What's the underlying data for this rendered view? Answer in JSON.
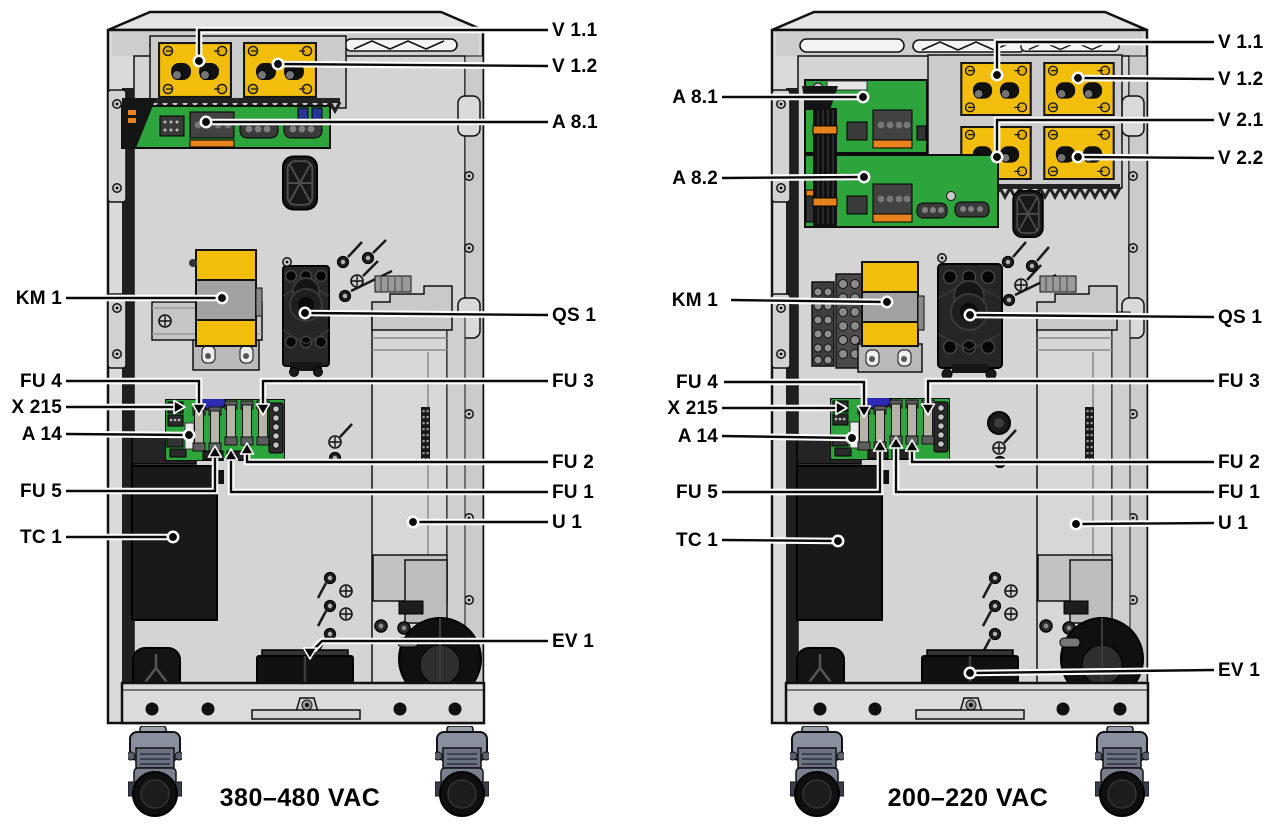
{
  "figure": {
    "description": "Interior component location diagrams of two power-source cabinet variants",
    "left_unit": {
      "caption": "380–480 VAC",
      "labels": {
        "v11": "V 1.1",
        "v12": "V 1.2",
        "a81": "A 8.1",
        "km1": "KM 1",
        "qs1": "QS 1",
        "fu4": "FU 4",
        "fu3": "FU 3",
        "x215": "X 215",
        "a14": "A 14",
        "fu2": "FU 2",
        "fu5": "FU 5",
        "fu1": "FU 1",
        "tc1": "TC 1",
        "u1": "U 1",
        "ev1": "EV 1"
      }
    },
    "right_unit": {
      "caption": "200–220 VAC",
      "labels": {
        "v11": "V 1.1",
        "v12": "V 1.2",
        "v21": "V 2.1",
        "v22": "V 2.2",
        "a81": "A 8.1",
        "a82": "A 8.2",
        "km1": "KM 1",
        "qs1": "QS 1",
        "fu4": "FU 4",
        "fu3": "FU 3",
        "x215": "X 215",
        "a14": "A 14",
        "fu2": "FU 2",
        "fu5": "FU 5",
        "fu1": "FU 1",
        "tc1": "TC 1",
        "u1": "U 1",
        "ev1": "EV 1"
      }
    },
    "colors": {
      "module_yellow": "#F3BE0B",
      "pcb_green": "#2EA43C",
      "cabinet_gray": "#DADADA",
      "connector_orange": "#E8821E",
      "component_blue": "#2B2BB4",
      "leader_black": "#0A0A0A"
    }
  }
}
